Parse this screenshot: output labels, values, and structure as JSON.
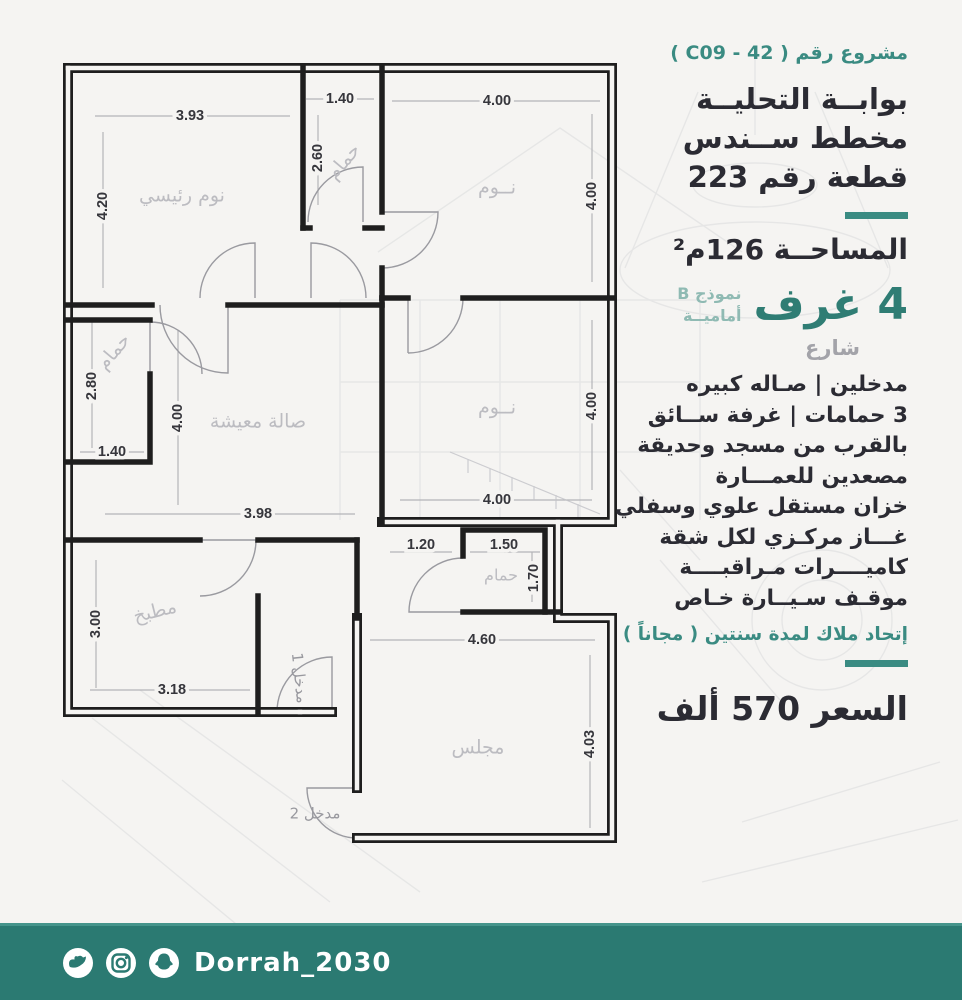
{
  "sidebar": {
    "project_label": "مشروع رقم ( C09 - 42 )",
    "title_lines": [
      "بوابــة التحليــة",
      "مخطط ســندس",
      "قطعة رقم 223"
    ],
    "area_line": "المساحــة 126م²",
    "rooms_big": "4 غرف",
    "model": [
      "نموذج B",
      "أماميــة"
    ],
    "street": "شارع",
    "features": [
      "مدخلين | صـاله كبيره",
      "3 حمامات | غرفة ســائق",
      "بالقرب من مسجد وحديقة",
      "مصعدين للعمـــارة",
      "خزان مستقل علوي وسفلي",
      "غـــاز مركـزي لكل شقة",
      "كاميــــرات مـراقبــــة",
      "موقـف سـيــارة خـاص",
      "إتحاد ملاك لمدة سنتين ( مجاناً )"
    ],
    "price_line": "السعر 570 ألف",
    "accent_color": "#3a8b82"
  },
  "floorplan": {
    "rooms": {
      "master_bedroom": "نوم رئيسي",
      "bath_top": "حمام",
      "bedroom_top": "نــوم",
      "bath_left": "حمام",
      "living": "صالة معيشة",
      "bedroom_mid": "نــوم",
      "kitchen": "مطبخ",
      "bath_small": "حمام",
      "majlis": "مجلس",
      "entrance1": "مدخل 1",
      "entrance2": "مدخل 2"
    },
    "dims": {
      "master_w": "3.93",
      "master_h": "4.20",
      "bath_top_w": "1.40",
      "bath_top_h": "2.60",
      "bed_top_w": "4.00",
      "bed_top_h": "4.00",
      "bath_left_h": "2.80",
      "bath_left_w": "1.40",
      "living_h": "4.00",
      "living_w": "3.98",
      "bed_mid_h": "4.00",
      "bed_mid_w": "4.00",
      "kitchen_h": "3.00",
      "kitchen_w": "3.18",
      "hall_w": "1.20",
      "bath_small_w": "1.50",
      "bath_small_h": "1.70",
      "majlis_w": "4.60",
      "majlis_h": "4.03"
    }
  },
  "footer": {
    "handle": "Dorrah_2030",
    "icons": [
      "twitter",
      "instagram",
      "snapchat"
    ],
    "bar_color": "#2b7a72"
  }
}
